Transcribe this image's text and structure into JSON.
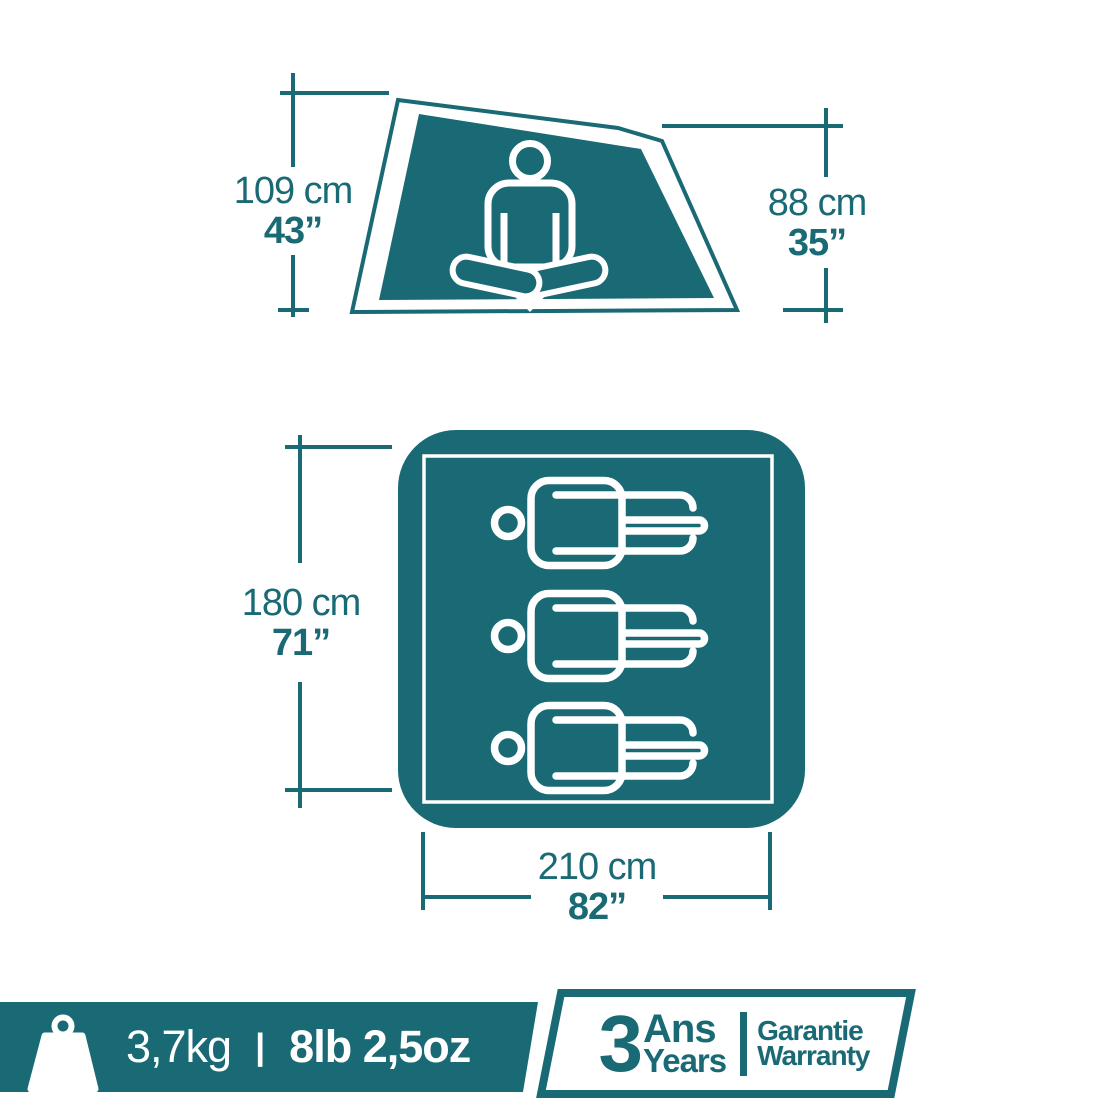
{
  "colors": {
    "teal": "#1A6A75",
    "white": "#FFFFFF"
  },
  "icons": {
    "sitting_person": "sitting-person-icon",
    "sleeping_person": "sleeping-person-icon",
    "weight": "weight-icon"
  },
  "floor_capacity_persons": 3,
  "dimensions": {
    "side_height": {
      "metric": "109 cm",
      "imperial": "43”"
    },
    "side_rear_height": {
      "metric": "88 cm",
      "imperial": "35”"
    },
    "floor_width": {
      "metric": "180 cm",
      "imperial": "71”"
    },
    "floor_length": {
      "metric": "210 cm",
      "imperial": "82”"
    }
  },
  "footer": {
    "weight": {
      "metric": "3,7kg",
      "separator": "|",
      "imperial": "8lb 2,5oz"
    },
    "warranty": {
      "years": "3",
      "fr_unit": "Ans",
      "en_unit": "Years",
      "fr_text": "Garantie",
      "en_text": "Warranty"
    }
  }
}
